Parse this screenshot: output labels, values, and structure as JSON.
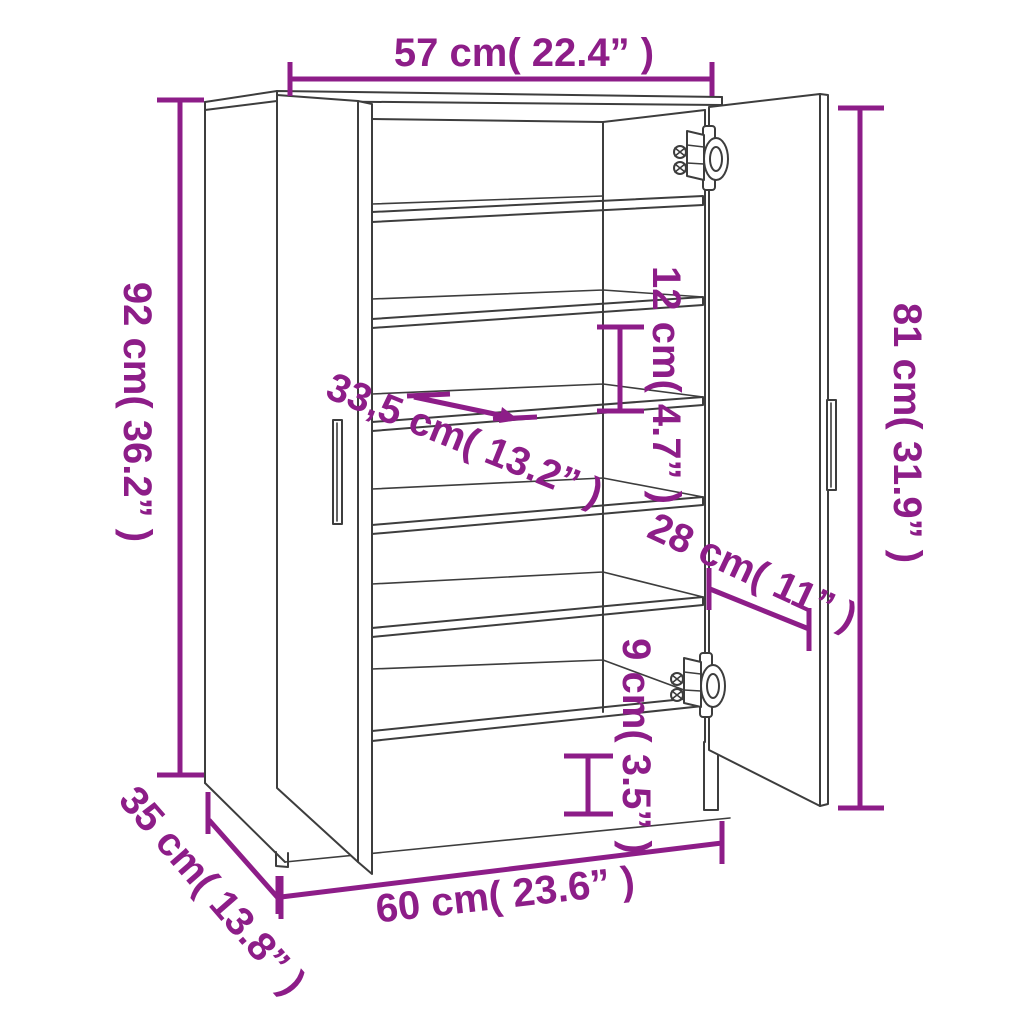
{
  "diagram": {
    "subject": "shoe-cabinet-dimension-diagram",
    "colors": {
      "accent": "#8d1d88",
      "line": "#3d3d3d",
      "background": "#ffffff"
    },
    "dims": {
      "top_width": "57 cm( 22.4” )",
      "left_height": "92 cm( 36.2” )",
      "right_height": "81 cm( 31.9” )",
      "shelf_gap": "12 cm( 4.7” )",
      "shelf_depth": "33,5 cm( 13.2” )",
      "door_width": "28 cm( 11” )",
      "ground_clearance": "9 cm( 3.5” )",
      "depth": "35 cm( 13.8” )",
      "bottom_width": "60 cm( 23.6” )"
    }
  }
}
